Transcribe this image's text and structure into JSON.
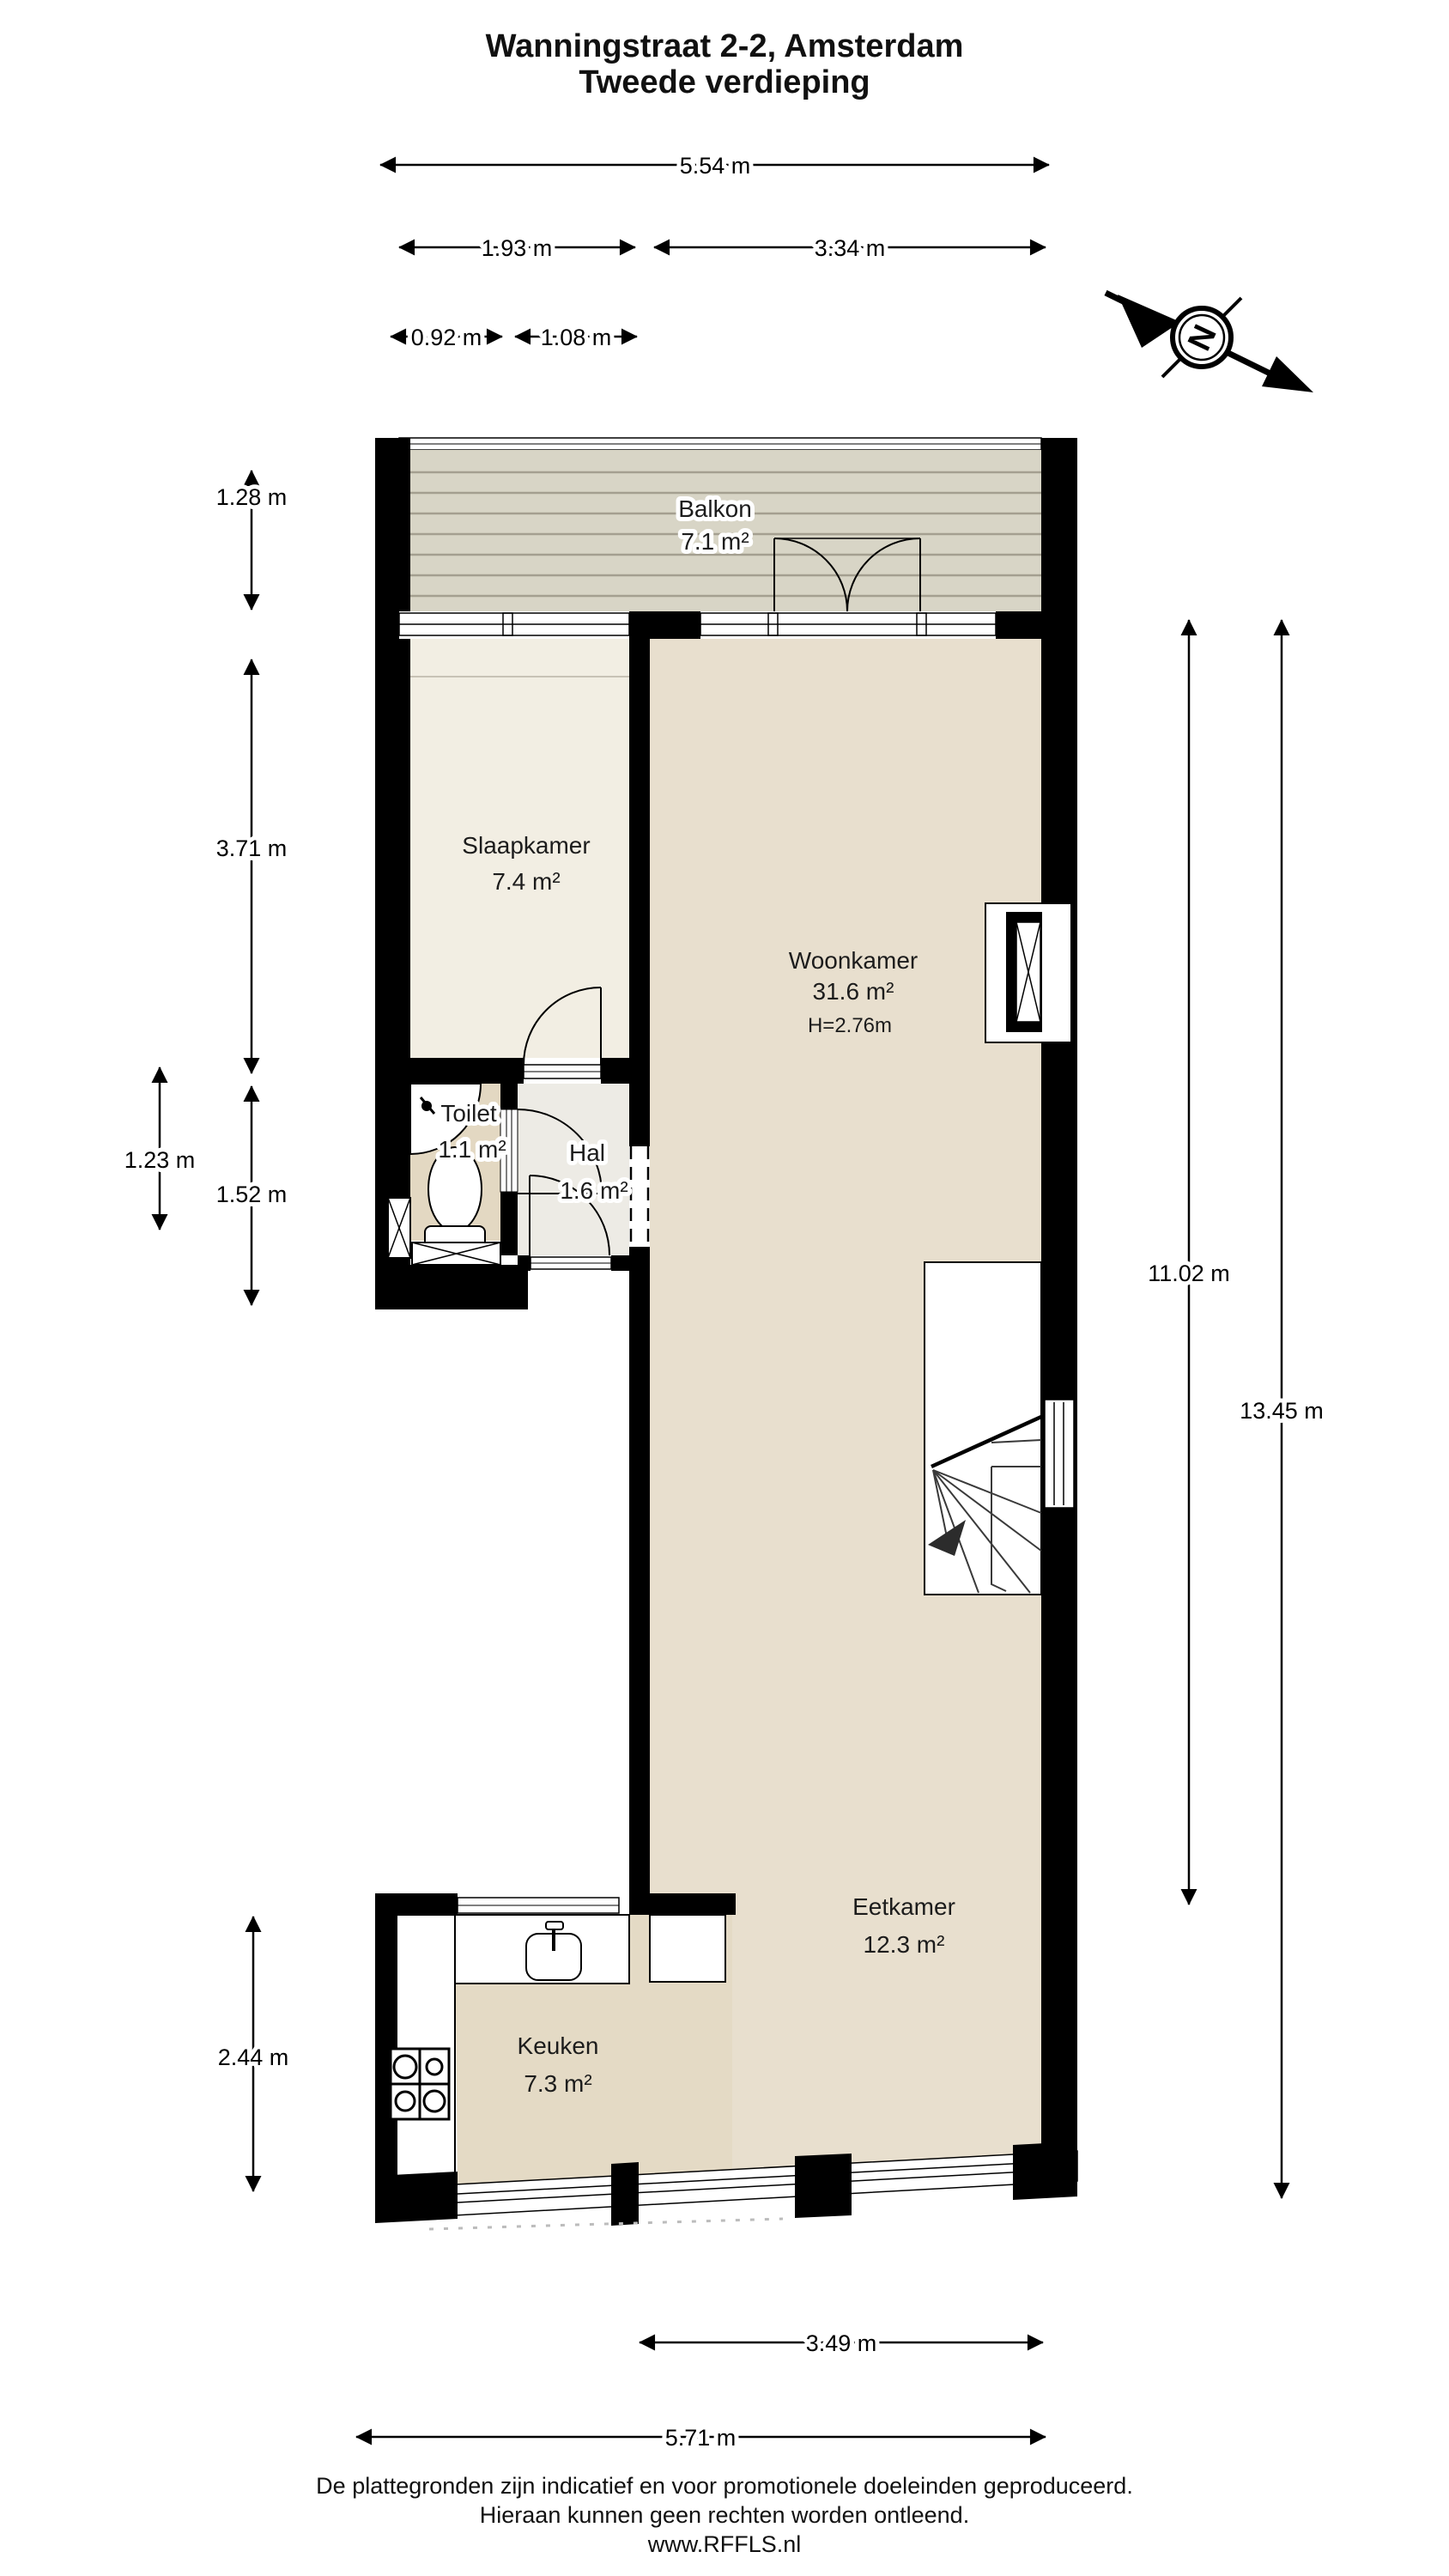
{
  "title": {
    "line1": "Wanningstraat 2-2, Amsterdam",
    "line2": "Tweede verdieping"
  },
  "rooms": {
    "balkon": {
      "name": "Balkon",
      "area": "7.1 m²"
    },
    "slaapkamer": {
      "name": "Slaapkamer",
      "area": "7.4 m²"
    },
    "woonkamer": {
      "name": "Woonkamer",
      "area": "31.6 m²",
      "ceiling_height": "H=2.76m"
    },
    "toilet": {
      "name": "Toilet",
      "area": "1.1 m²"
    },
    "hal": {
      "name": "Hal",
      "area": "1.6 m²"
    },
    "eetkamer": {
      "name": "Eetkamer",
      "area": "12.3 m²"
    },
    "keuken": {
      "name": "Keuken",
      "area": "7.3 m²"
    }
  },
  "dimensions": {
    "top_total": "5.54 m",
    "top_left": "1.93 m",
    "top_right": "3.34 m",
    "window_left": "0.92 m",
    "window_right": "1.08 m",
    "left_balcony": "1.28 m",
    "left_bedroom": "3.71 m",
    "left_toilet_outer": "1.23 m",
    "left_toilet": "1.52 m",
    "left_kitchen": "2.44 m",
    "right_inner": "11.02 m",
    "right_outer": "13.45 m",
    "bottom_dining": "3.49 m",
    "bottom_total": "5.71 m"
  },
  "compass": {
    "north_letter": "N"
  },
  "footer": {
    "line1": "De plattegronden zijn indicatief en voor promotionele doeleinden geproduceerd.",
    "line2": "Hieraan kunnen geen rechten worden ontleend.",
    "line3": "www.RFFLS.nl"
  },
  "colors": {
    "wall": "#000000",
    "floor_living": "#e8dfce",
    "floor_bedroom": "#f2eee3",
    "floor_hall": "#edebe5",
    "floor_wet": "#e3d8c2",
    "floor_kitchen": "#e4dac5",
    "balcony_deck": "#d8d5c6",
    "balcony_plank": "#a49f90",
    "stair_line": "#3a3a3a",
    "roof_dash": "#bcbcbc"
  }
}
